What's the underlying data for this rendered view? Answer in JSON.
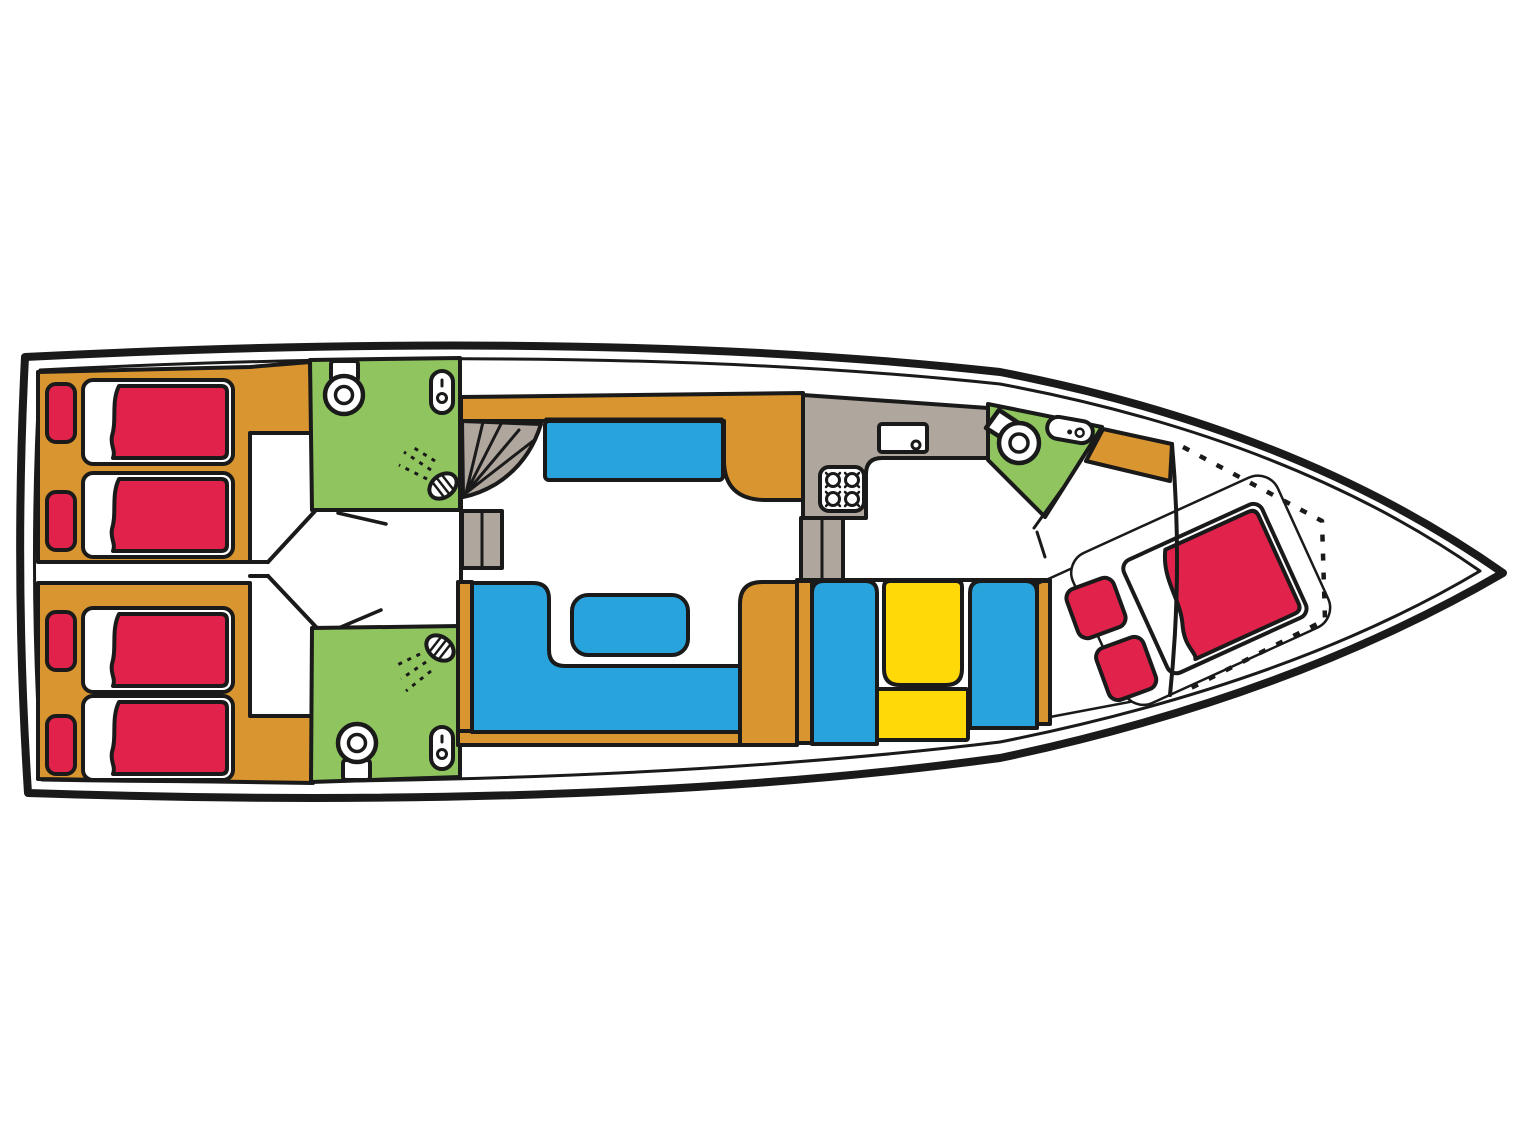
{
  "diagram": {
    "title": "Motor yacht interior floor plan (lower deck, bow to the right)",
    "type": "boat-floor-plan"
  },
  "colors": {
    "background": "#FFFFFF",
    "white": "#FFFFFF",
    "outline": "#1A1A1A",
    "wood": "#D9952F",
    "red": "#E1234B",
    "green": "#8FC45E",
    "blue": "#29A3DC",
    "yellow": "#FFD908",
    "gray": "#AFA69E"
  },
  "rooms": [
    {
      "name": "Aft cabin port with two single beds"
    },
    {
      "name": "Aft cabin starboard with two single beds"
    },
    {
      "name": "Bathroom port with toilet, washbasin and shower"
    },
    {
      "name": "Bathroom starboard with toilet, washbasin and shower"
    },
    {
      "name": "Salon with sofas, coffee table and companionway stairs"
    },
    {
      "name": "Galley with sink and four burner stove"
    },
    {
      "name": "Dinette with two benches and table"
    },
    {
      "name": "Bow bathroom with toilet and washbasin"
    },
    {
      "name": "Bow cabin with double bed on V-berth"
    }
  ]
}
